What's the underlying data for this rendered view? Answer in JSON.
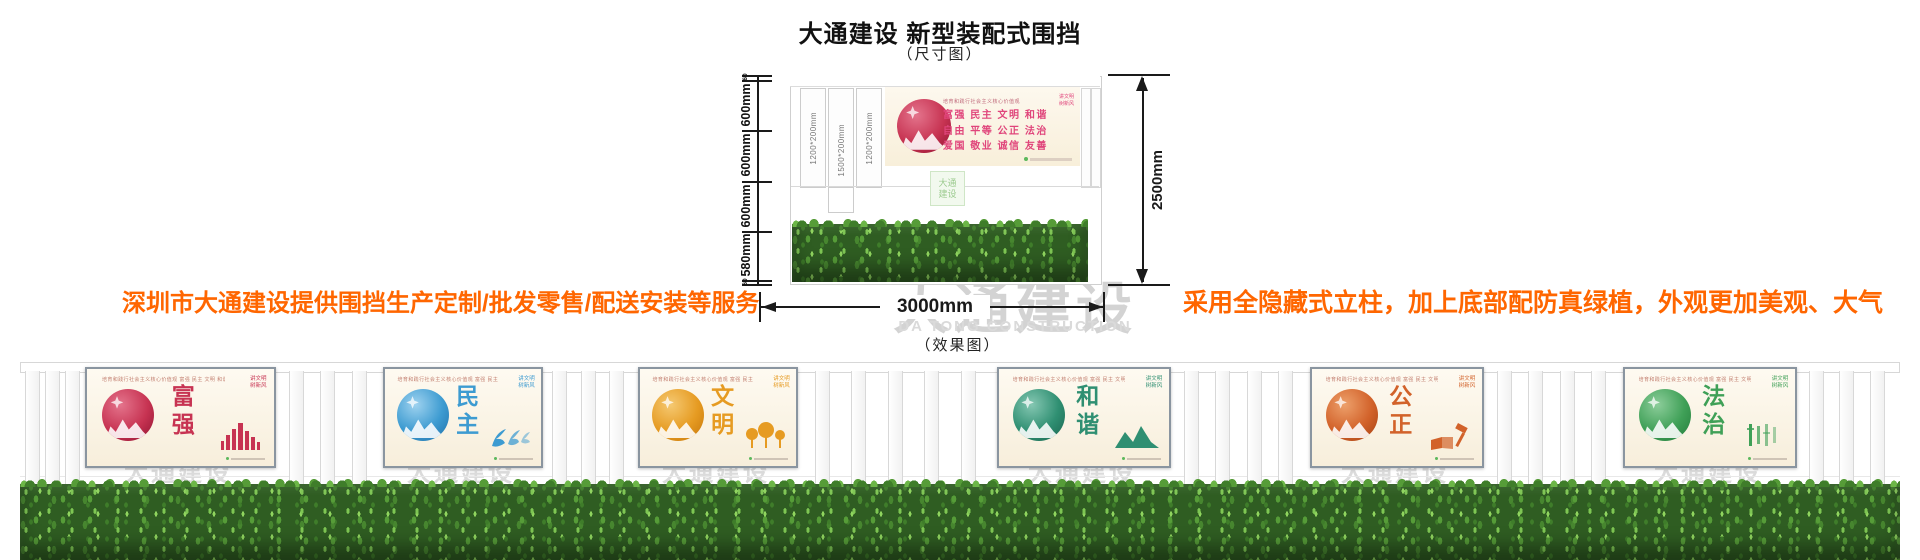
{
  "header": {
    "title": "大通建设 新型装配式围挡",
    "dimension_caption": "（尺寸图）",
    "effect_caption": "（效果图）"
  },
  "notes": {
    "left": "深圳市大通建设提供围挡生产定制/批发零售/配送安装等服务",
    "right": "采用全隐藏式立柱，加上底部配防真绿植，外观更加美观、大气",
    "color": "#ff6600"
  },
  "brand_watermark": {
    "cn": "大通建设",
    "en": "DA TONG CONSTRUCTION"
  },
  "dimension_diagram": {
    "left_chain": [
      "60",
      "600mm",
      "600mm",
      "600mm",
      "580mm",
      "60"
    ],
    "post_labels": [
      "1200*200mm",
      "1500*200mm",
      "1200*200mm"
    ],
    "total_height": "2500mm",
    "total_width": "3000mm",
    "board": {
      "slogan_header": "培育和践行社会主义核心价值观",
      "corner_line1": "讲文明",
      "corner_line2": "树新风",
      "value_rows": [
        "富强 民主 文明 和谐",
        "自由 平等 公正 法治",
        "爱国 敬业 诚信 友善"
      ],
      "text_color": "#e0457b"
    }
  },
  "effect_fence": {
    "top_line": "培育和践行社会主义核心价值观  富强 民主 文明 和谐 自由 平等 公正 法治 爱国 敬业 诚信 友善",
    "corner_line1": "讲文明",
    "corner_line2": "树新风",
    "panels": [
      {
        "word": "富强",
        "theme_color": "#c73352"
      },
      {
        "word": "民主",
        "theme_color": "#3d9bd1"
      },
      {
        "word": "文明",
        "theme_color": "#e69b22"
      },
      {
        "word": "和谐",
        "theme_color": "#2f8f72"
      },
      {
        "word": "公正",
        "theme_color": "#d2622a"
      },
      {
        "word": "法治",
        "theme_color": "#3fa057"
      }
    ]
  },
  "colors": {
    "note_orange": "#ff6600",
    "dimension_line": "#1a1a1a",
    "watermark_gray": "#d4d4d4",
    "panel_cream": "#fdf6e7",
    "hedge_green": "#2f5d22"
  }
}
